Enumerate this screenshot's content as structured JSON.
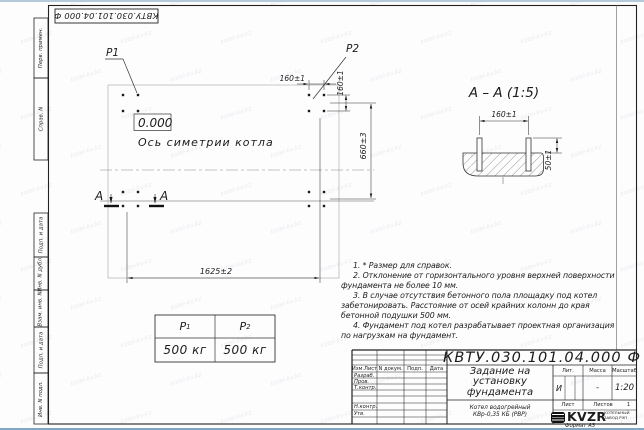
{
  "watermark": "kotel-kv.kz",
  "stamp": {
    "number": "КВТУ.030.101.04.000 Ф"
  },
  "margin": {
    "c1": "Перв. примен.",
    "c2": "Справ. N",
    "c3": "Подп. и дата",
    "c4": "Инв. N дубл.",
    "c5": "Взам. инв. N",
    "c6": "Подп. и дата",
    "c7": "Инв. N подл."
  },
  "plan": {
    "p1": "P1",
    "p2": "P2",
    "level": "0.000",
    "axis": "Ось симетрии котла",
    "dim_x": "160±1",
    "dim_y": "160±1",
    "width": "1625±2",
    "depth": "660±3",
    "sec": "А"
  },
  "section": {
    "title": "А – А (1:5)",
    "dim": "160±1",
    "height": "50±1"
  },
  "loads": {
    "h1": "Р",
    "h1_sub": "1",
    "h2": "Р",
    "h2_sub": "2",
    "v1": "500 кг",
    "v2": "500 кг"
  },
  "notes": [
    "1. * Размер для справок.",
    "2. Отклонение от горизонтального уровня верхней поверхности фундамента не более 10 мм.",
    "3. В случае отсутствия бетонного пола площадку под котел забетонировать. Расстояние от осей крайних колонн до края бетонной подушки 500 мм.",
    "4. Фундамент под котел разрабатывает проектная организация по нагрузкам на фундамент."
  ],
  "tb": {
    "number": "КВТУ.030.101.04.000 Ф",
    "title1": "Задание на",
    "title2": "установку",
    "title3": "фундамента",
    "product1": "Котел водогрейный",
    "product2": "КВр-0,35 КБ (РВР)",
    "h_izm": "Изм.Лист",
    "h_doc": "N докум.",
    "h_podp": "Подп.",
    "h_data": "Дата",
    "r1": "Разраб.",
    "r2": "Пров.",
    "r3": "Т.контр.",
    "r4": "Н.контр.",
    "r5": "Утв.",
    "lit": "Лит.",
    "mass": "Масса",
    "scale": "Масштаб",
    "lit_v": "И",
    "mass_v": "-",
    "scale_v": "1:20",
    "sheet": "Лист",
    "sheets": "Листов",
    "sheets_v": "1",
    "logo": "KVZR",
    "logo_cap1": "КОТЕЛЬНЫЙ",
    "logo_cap2": "ЗАВОД РЭП",
    "format": "Формат А3"
  }
}
